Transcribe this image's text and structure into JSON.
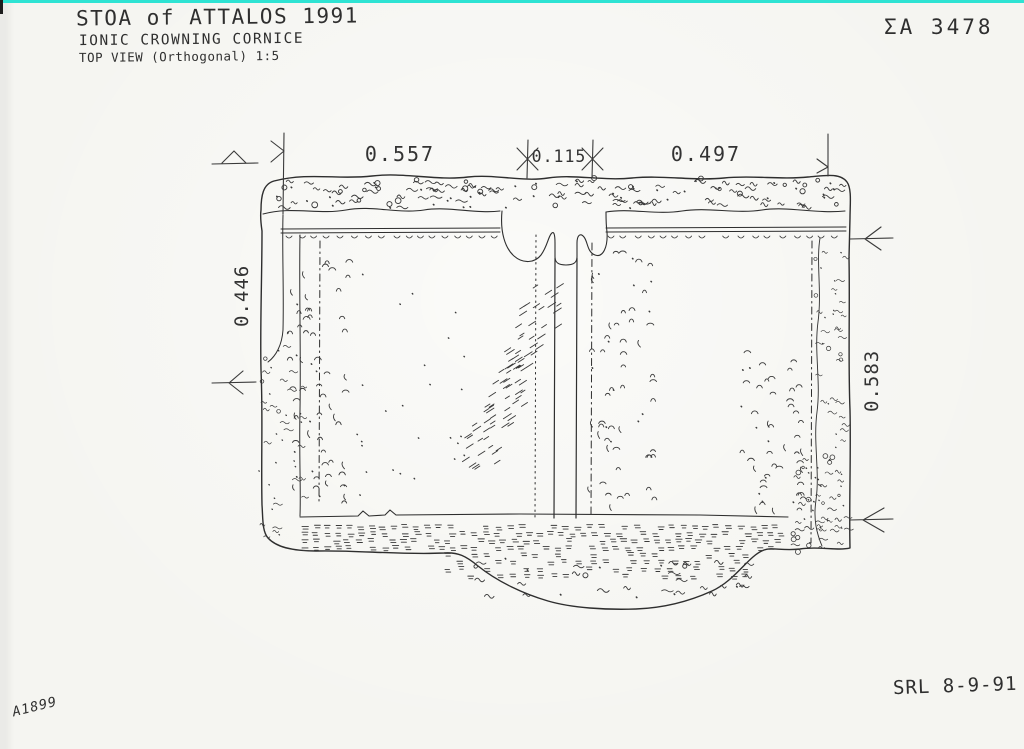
{
  "page": {
    "background": "#f5f5f1",
    "scanner_line_color": "#2ee3d3",
    "ink_color": "#2e2e2e",
    "texture_color": "#3a3a3a"
  },
  "title_block": {
    "line1": "STOA of ATTALOS 1991",
    "line2": "IONIC CROWNING CORNICE",
    "line3": "TOP VIEW (Orthogonal) 1:5"
  },
  "labels": {
    "catalog_number": "ΣΑ 3478",
    "signature": "SRL 8-9-91",
    "negative_number": "A1899"
  },
  "dimensions": {
    "top_left": "0.557",
    "joint_width": "0.115",
    "top_right": "0.497",
    "left_height": "0.446",
    "right_height": "0.583"
  }
}
